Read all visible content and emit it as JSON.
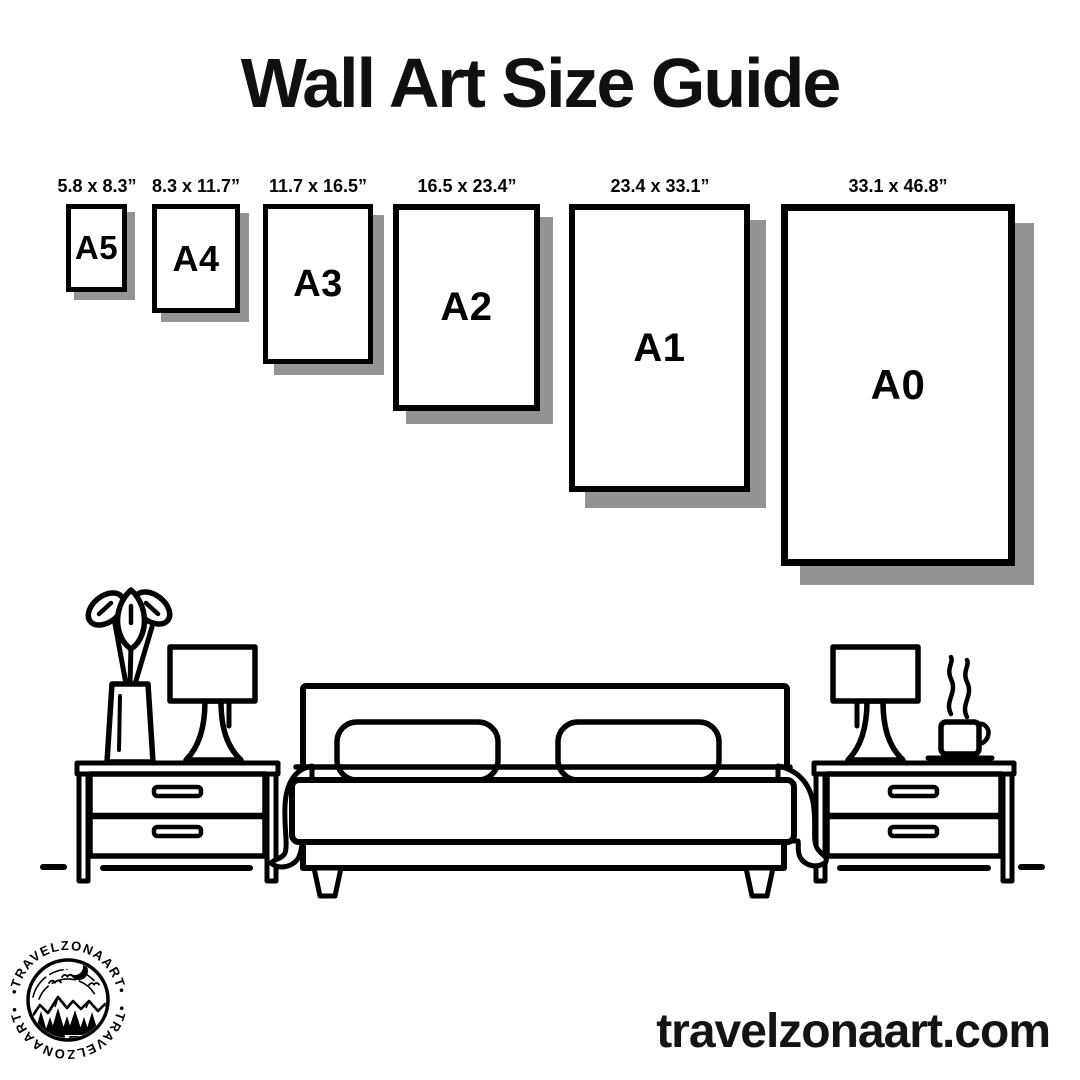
{
  "title": "Wall Art Size Guide",
  "sizes": [
    {
      "code": "A5",
      "dimensions": "5.8 x 8.3”"
    },
    {
      "code": "A4",
      "dimensions": "8.3 x 11.7”"
    },
    {
      "code": "A3",
      "dimensions": "11.7 x 16.5”"
    },
    {
      "code": "A2",
      "dimensions": "16.5 x 23.4”"
    },
    {
      "code": "A1",
      "dimensions": "23.4 x 33.1”"
    },
    {
      "code": "A0",
      "dimensions": "33.1 x 46.8”"
    }
  ],
  "footer": {
    "website": "travelzonaart.com"
  },
  "logo": {
    "brand": "TRAVELZONAART",
    "arc_top": "•TRAVELZONAART•",
    "arc_bottom": "•TRAVELZONAART•"
  },
  "colors": {
    "ink": "#000000",
    "shadow": "#949494",
    "background": "#ffffff"
  },
  "illustration": {
    "name": "bedroom-line-art",
    "elements": [
      "potted-plant",
      "left-nightstand",
      "left-table-lamp",
      "double-bed-with-two-pillows-and-blanket",
      "right-table-lamp",
      "steaming-coffee-cup",
      "right-nightstand",
      "floor-line"
    ]
  }
}
